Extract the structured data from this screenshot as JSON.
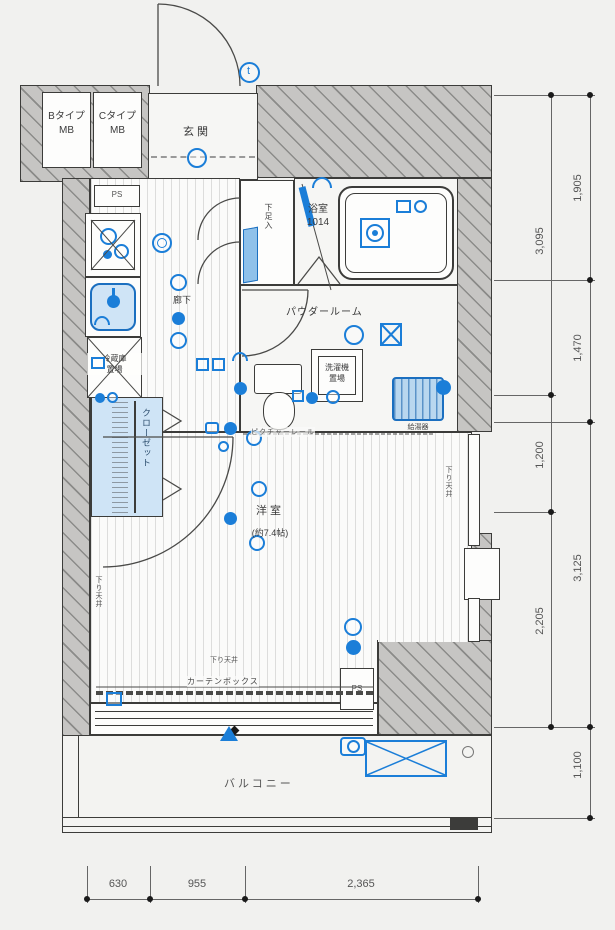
{
  "plan": {
    "mb_left": {
      "line1": "Bタイプ",
      "line2": "MB"
    },
    "mb_right": {
      "line1": "Cタイプ",
      "line2": "MB"
    },
    "entrance": "玄関",
    "ps_top": "PS",
    "ps_bottom": "PS",
    "shoe_box": "下足入",
    "bathroom": {
      "line1": "浴室",
      "line2": "1014"
    },
    "powder_room": "パウダールーム",
    "washer": {
      "line1": "洗濯機",
      "line2": "置場"
    },
    "water_heater": "給湯器",
    "fridge": {
      "line1": "冷蔵庫",
      "line2": "置場"
    },
    "closet": "クローゼット",
    "corridor": "廊下",
    "room": {
      "name": "洋室",
      "size": "(約7.4帖)"
    },
    "picture_rail": "ピクチャーレール",
    "dropped_ceiling_right": "下り天井",
    "dropped_ceiling_left": "下り天井",
    "dropped_ceiling_bottom": "下り天井",
    "curtain_box": "カーテンボックス",
    "balcony": "バルコニー",
    "door_mark": "t"
  },
  "dimensions": {
    "right_inner": [
      "3,095",
      "1,200",
      "2,205"
    ],
    "right_outer": [
      "1,905",
      "1,470",
      "3,125",
      "1,100"
    ],
    "bottom": [
      "630",
      "955",
      "2,365"
    ]
  },
  "colors": {
    "symbol_blue": "#1b7ed8",
    "light_blue_fill": "#cfe4f6",
    "wall_gray": "#c6c5c3",
    "line_dark": "#3c3c3a",
    "background": "#f1f1ef"
  }
}
